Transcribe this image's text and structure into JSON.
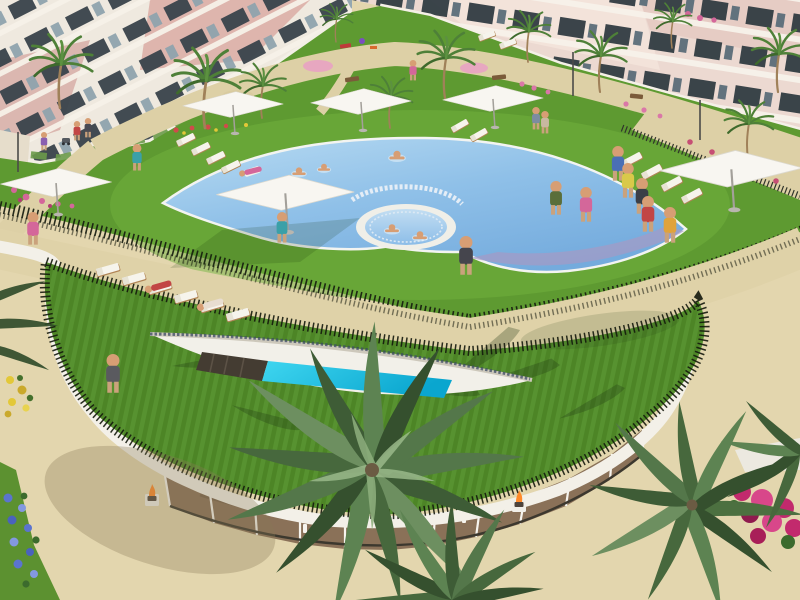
{
  "scene": {
    "title": "Aerial 3D architectural rendering of a resort-style residential complex",
    "description": "Bird's-eye render of an apartment complex: pink-and-white apartment blocks with balconies line the top; a landscaped garden with palm trees, flower beds, benches and pink play circles sits in front; a large crescent-shaped swimming pool wraps around a circular spa pool on a sunny lawn with white square parasols and rows of sun loungers used by residents; below a sandy walkway, a curved green roof edged with a dark spiked fence contains a lens-shaped cut revealing a turquoise indoor lap pool; beneath it a curved glass pavilion with white mullions and fire bowls opens onto a sandy plaza with large overhead palm crowns, magenta bougainvillea and blue and yellow flower beds."
  },
  "palette": {
    "sand": "#e0d3aa",
    "plaza_sand": "#e6dab4",
    "grass_garden": "#5e9a31",
    "grass_sunlit": "#72b13d",
    "grass_roof": "#4d8526",
    "pool_water_light": "#aed3ef",
    "pool_water_deep": "#7cb0e0",
    "lap_pool_turquoise": "#1ac4e6",
    "umbrella_white": "#f8f6f1",
    "building_white": "#efe9df",
    "building_pink": "#d9a8a0",
    "building_pale_pink": "#ecd9d1",
    "window_dark": "#39434b",
    "hedge_spikes": "#171c10",
    "palm_green": "#4e8038",
    "bougainvillea_magenta": "#c22a6d",
    "flowers_blue": "#5b74cf",
    "flowers_yellow": "#e3c838",
    "flame_orange": "#ff8a2a",
    "wood_interior": "#8a7158"
  },
  "inventory": {
    "buildings": 2,
    "parasols": 6,
    "sun_loungers": 16,
    "pools": [
      "main crescent pool",
      "circular spa pool",
      "indoor lap pool"
    ],
    "fire_bowls": 2,
    "foreground_palm_crowns": 3,
    "people_visible": "about 25 residents walking, sunbathing and swimming"
  }
}
